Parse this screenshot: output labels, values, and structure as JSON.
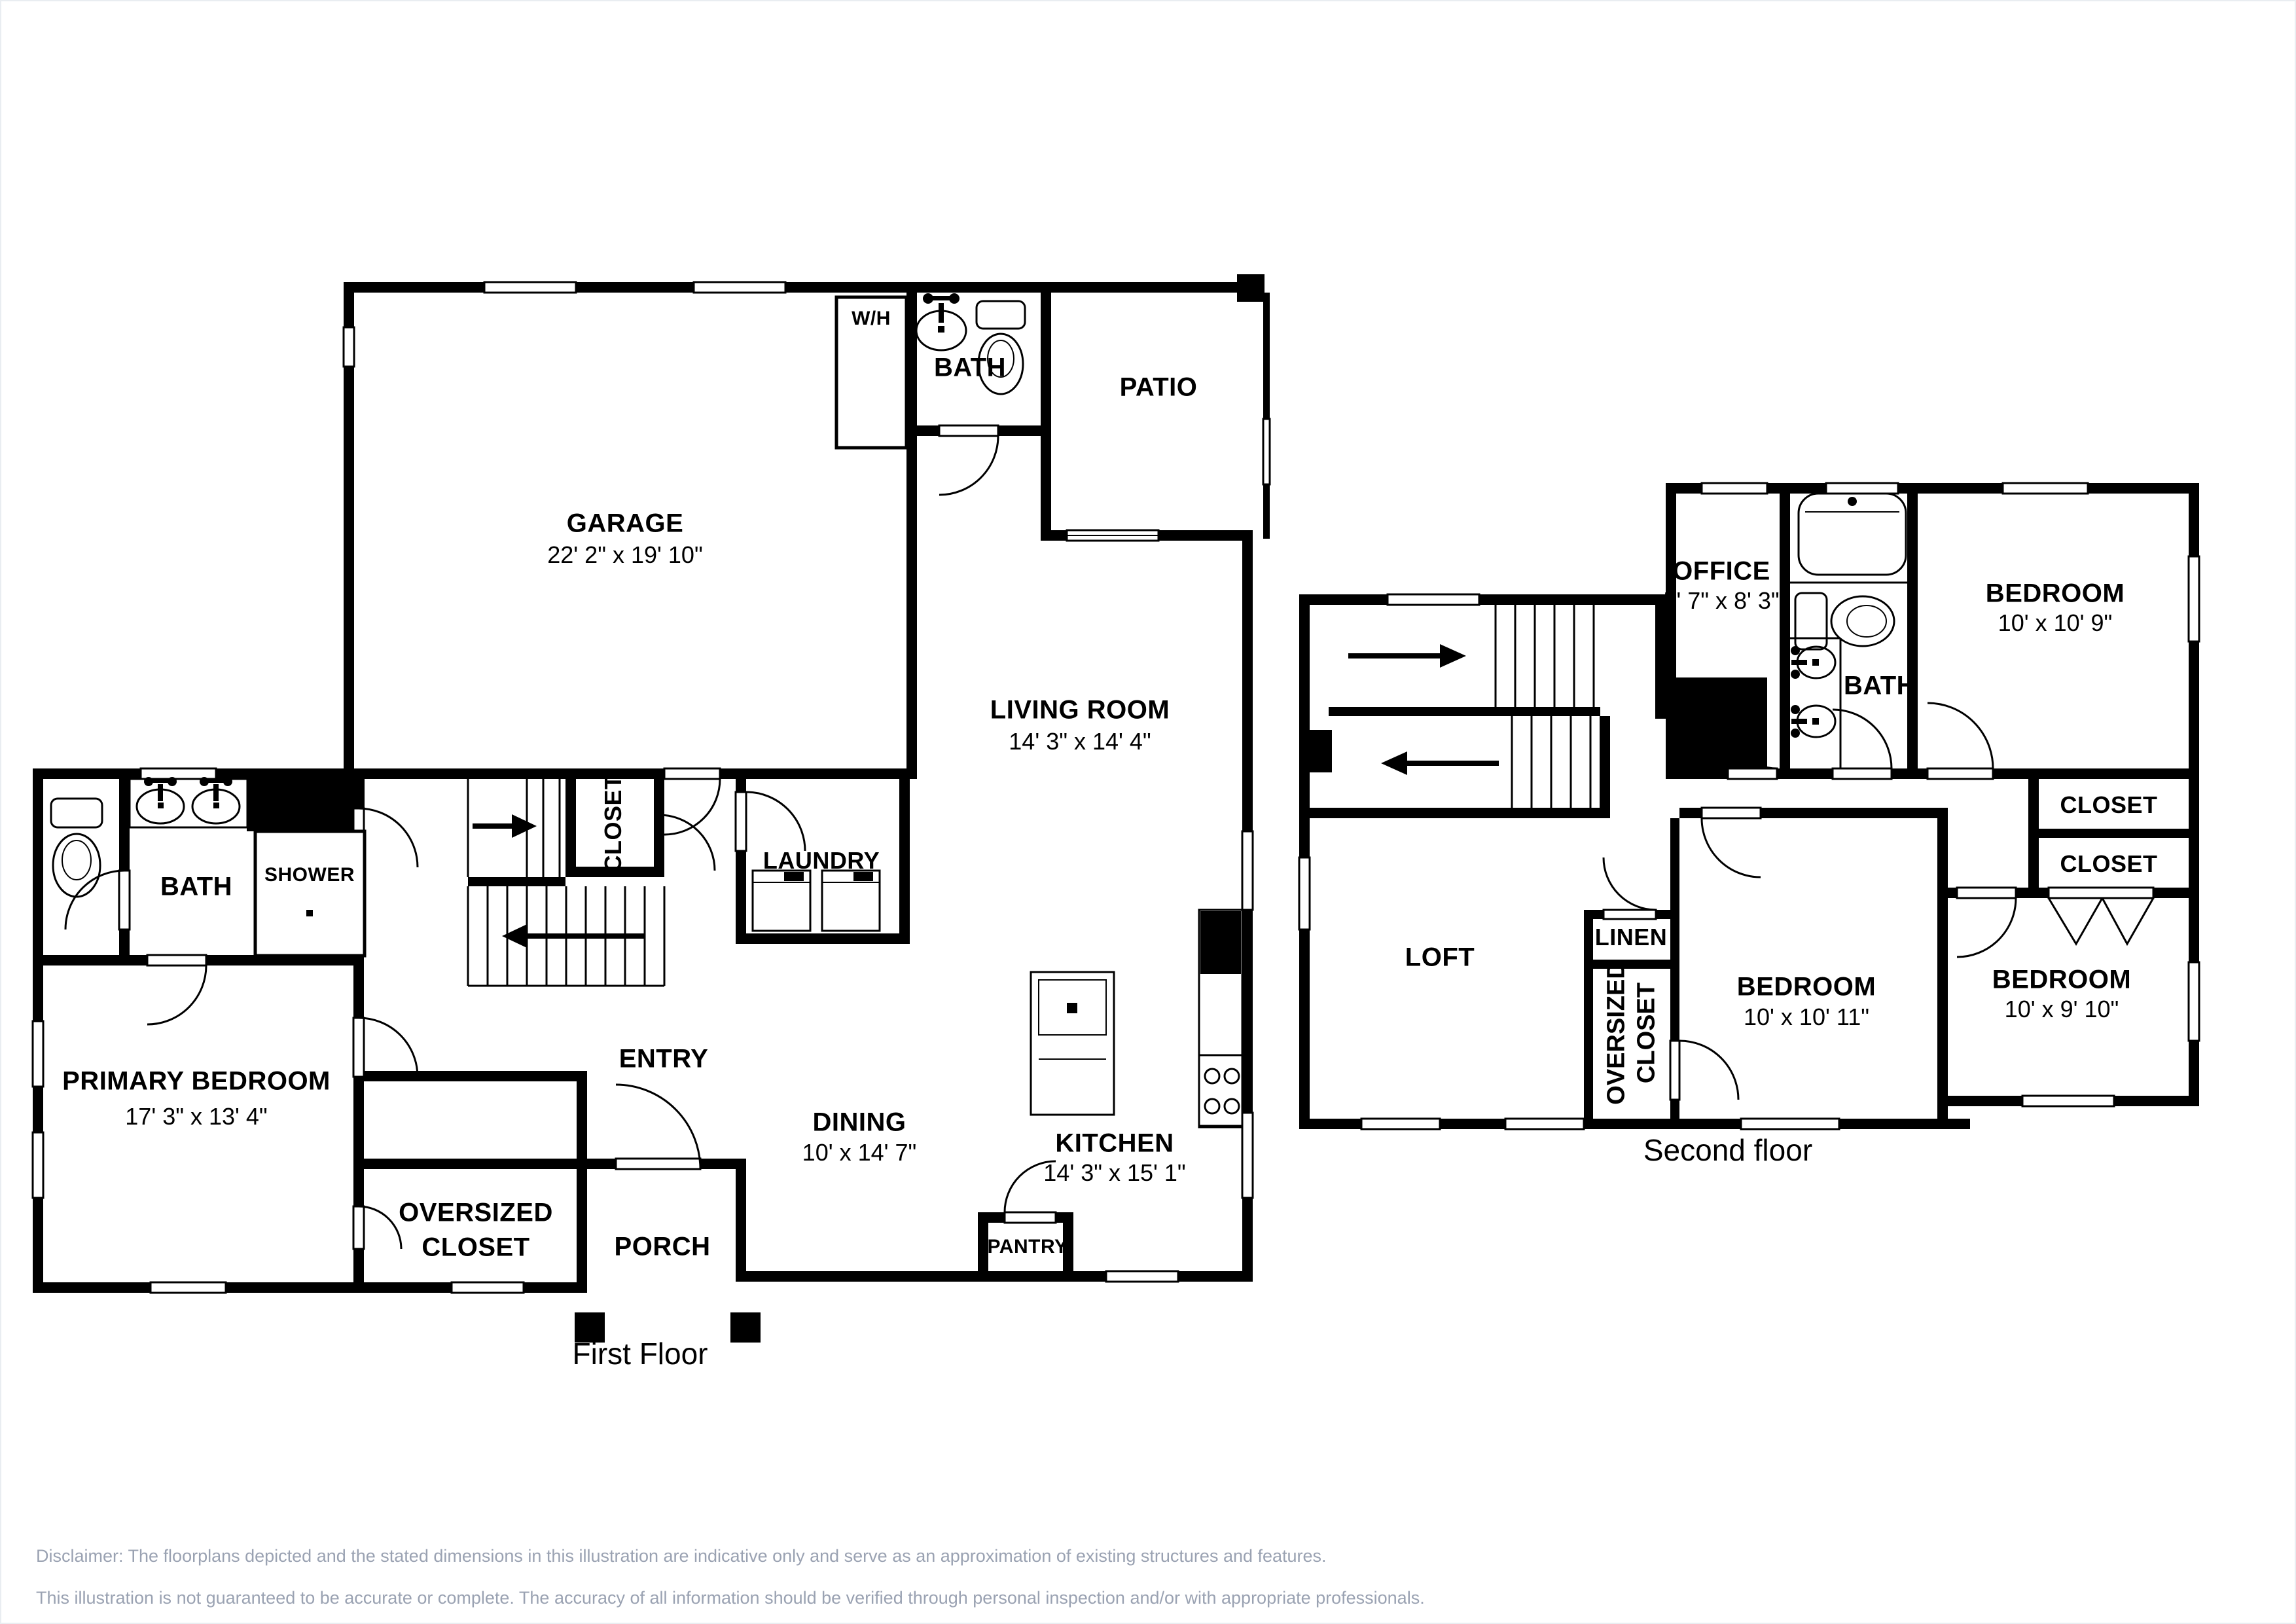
{
  "first_floor": {
    "caption": "First Floor",
    "rooms": {
      "garage": {
        "name": "GARAGE",
        "dims": "22' 2\" x 19' 10\""
      },
      "water_heater": {
        "name": "W/H"
      },
      "bath_upper": {
        "name": "BATH"
      },
      "patio": {
        "name": "PATIO"
      },
      "living_room": {
        "name": "LIVING ROOM",
        "dims": "14' 3\" x 14' 4\""
      },
      "hall_closet": {
        "name": "CLOSET"
      },
      "laundry": {
        "name": "LAUNDRY"
      },
      "primary_bath": {
        "name": "BATH"
      },
      "shower": {
        "name": "SHOWER"
      },
      "primary_bedroom": {
        "name": "PRIMARY BEDROOM",
        "dims": "17' 3\" x 13' 4\""
      },
      "oversized_closet": {
        "name_line1": "OVERSIZED",
        "name_line2": "CLOSET"
      },
      "entry": {
        "name": "ENTRY"
      },
      "porch": {
        "name": "PORCH"
      },
      "dining": {
        "name": "DINING",
        "dims": "10' x 14' 7\""
      },
      "kitchen": {
        "name": "KITCHEN",
        "dims": "14' 3\" x 15' 1\""
      },
      "pantry": {
        "name": "PANTRY"
      }
    }
  },
  "second_floor": {
    "caption": "Second floor",
    "rooms": {
      "office": {
        "name": "OFFICE",
        "dims": "5' 7\" x 8' 3\""
      },
      "bedroom_top": {
        "name": "BEDROOM",
        "dims": "10' x 10' 9\""
      },
      "bath": {
        "name": "BATH"
      },
      "closet_1": {
        "name": "CLOSET"
      },
      "closet_2": {
        "name": "CLOSET"
      },
      "loft": {
        "name": "LOFT"
      },
      "linen": {
        "name": "LINEN"
      },
      "oversized_closet": {
        "name_line1": "OVERSIZED",
        "name_line2": "CLOSET"
      },
      "bedroom_mid": {
        "name": "BEDROOM",
        "dims": "10' x 10' 11\""
      },
      "bedroom_right": {
        "name": "BEDROOM",
        "dims": "10' x 9' 10\""
      }
    }
  },
  "disclaimer": {
    "line1": "Disclaimer: The floorplans depicted and the stated dimensions in this illustration are indicative only and serve as an approximation of existing structures and features.",
    "line2": "This illustration is not guaranteed to be accurate or complete. The accuracy of all information should be verified through personal inspection and/or with appropriate professionals."
  },
  "icons": {
    "stairs-up-arrow": "→",
    "stairs-down-arrow": "←"
  },
  "colors": {
    "walls": "#000000",
    "background": "#ffffff",
    "disclaimer_text": "#9aa2b2"
  }
}
